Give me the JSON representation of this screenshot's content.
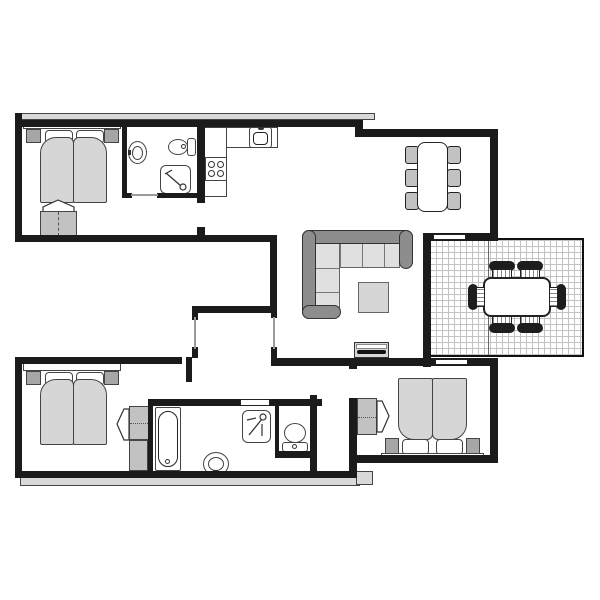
{
  "document": {
    "kind": "floor-plan-drawing",
    "visible_text": [],
    "rooms": [
      {
        "id": "bedroom-top-left",
        "furniture": [
          "double-bed",
          "pillow",
          "pillow",
          "nightstand",
          "nightstand",
          "headboard",
          "wardrobe-with-door-arrow"
        ]
      },
      {
        "id": "bathroom-top",
        "furniture": [
          "washbasin",
          "toilet",
          "shower"
        ]
      },
      {
        "id": "kitchen",
        "furniture": [
          "l-shaped-counter",
          "kitchen-sink",
          "cooktop-4-burners"
        ]
      },
      {
        "id": "dining-area",
        "furniture": [
          "dining-table",
          "dining-chair",
          "dining-chair",
          "dining-chair",
          "dining-chair",
          "dining-chair",
          "dining-chair"
        ]
      },
      {
        "id": "living-area",
        "furniture": [
          "corner-sofa",
          "coffee-table",
          "tv-cabinet"
        ]
      },
      {
        "id": "entrance-hall",
        "furniture": []
      },
      {
        "id": "bedroom-bottom-left",
        "furniture": [
          "double-bed",
          "pillow",
          "pillow",
          "nightstand",
          "nightstand",
          "headboard",
          "wardrobe-with-door-arrow",
          "cabinet"
        ]
      },
      {
        "id": "bathroom-bottom",
        "furniture": [
          "bathtub",
          "washbasin",
          "shower",
          "toilet"
        ]
      },
      {
        "id": "bedroom-bottom-right",
        "furniture": [
          "double-bed",
          "pillow",
          "pillow",
          "nightstand",
          "nightstand",
          "headboard",
          "wardrobe-with-door-arrow"
        ]
      },
      {
        "id": "terrace",
        "furniture": [
          "outdoor-dining-table",
          "outdoor-chair",
          "outdoor-chair",
          "outdoor-chair",
          "outdoor-chair",
          "outdoor-chair",
          "outdoor-chair"
        ]
      }
    ],
    "openings": [
      "entrance-door",
      "sliding-door-terrace-top",
      "sliding-door-terrace-bottom",
      "bathroom-door-top",
      "bathroom-door-bottom",
      "bedroom-door-openings"
    ]
  },
  "colors": {
    "background": "#ffffff",
    "wall": "#1b1b1b",
    "line": "#444444",
    "outline_dark": "#222222",
    "furniture_light": "#d6d6d6",
    "furniture_mid": "#c2c2c2",
    "furniture_dark": "#a6a6a6",
    "sofa_frame": "#8d8d8d",
    "sofa_cushion": "#e0e0e0",
    "pavement": "#d9d9d9",
    "grid_line": "#c3c3c3",
    "door_line": "#9a9a9a",
    "chair_black": "#1d1d1d"
  }
}
